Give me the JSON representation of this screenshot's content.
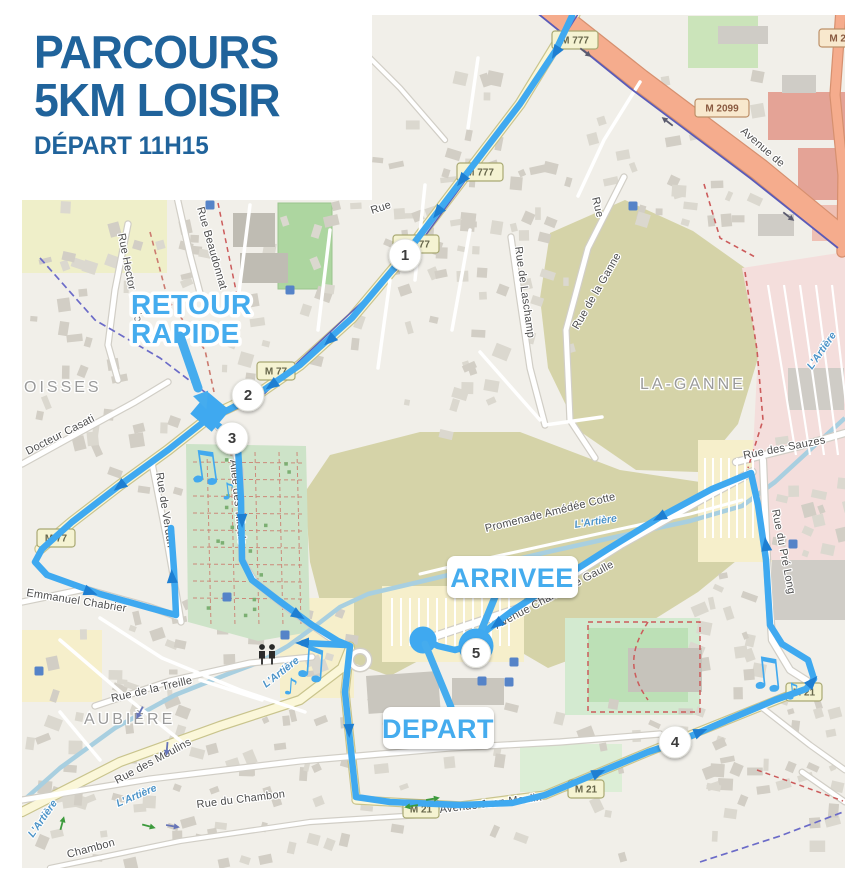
{
  "title": {
    "line1": "PARCOURS",
    "line2": "5KM LOISIR",
    "line3": "DÉPART 11H15"
  },
  "callouts": {
    "retour_line1": "RETOUR",
    "retour_line2": "RAPIDE",
    "arrivee": "ARRIVEE",
    "depart": "DEPART"
  },
  "waypoints": {
    "wp1": "1",
    "wp2": "2",
    "wp3": "3",
    "wp4": "4",
    "wp5": "5"
  },
  "road_badges": {
    "m777_top": "M 777",
    "m777_mid": "M 777",
    "m777_wp1": "M 777",
    "m77_mid": "M 77",
    "m77_left": "M 77",
    "m2099": "M 2099",
    "m2099_corner": "M 2099",
    "m21_a": "M 21",
    "m21_b": "M 21",
    "m21_c": "M 21"
  },
  "streets": {
    "beaudonnat": "Rue Beaudonnat",
    "berlioz": "Rue Hector Berlioz",
    "casati": "Docteur Casati",
    "verdun": "Rue de Verdun",
    "tilleuls": "Allée des Tilleuls",
    "chabrier": "Emmanuel Chabrier",
    "laschamp": "Rue de Laschamp",
    "ganne": "Rue de la Ganne",
    "sauzes": "Rue des Sauzes",
    "prelong": "Rue du Pré Long",
    "promenade": "Promenade Amédée Cotte",
    "gaulle": "Avenue Charles de Gaulle",
    "avenue_de": "Avenue de",
    "treille": "Rue de la Treille",
    "moulins": "Rue des Moulins",
    "chambon_rue": "Rue du Chambon",
    "chambon": "Chambon",
    "jeanmoulin": "Avenue Jean Moulin",
    "rue": "Rue"
  },
  "areas": {
    "oisses": "OISSES",
    "laganne": "LA-GANNE",
    "aubiere": "AUBIÈRE"
  },
  "river": {
    "name": "L'Artière"
  },
  "icons": {
    "music": "♫",
    "music_small": "♪"
  },
  "colors": {
    "title_blue": "#20639B",
    "route_blue": "#3FA9F0",
    "arrow_blue": "#1E7FD2",
    "callout_blue": "#45ACEE",
    "river_blue": "#A8CFE0",
    "road_yellow": "#FBF7D9",
    "trunk_orange": "#F5AC8D",
    "field_olive": "#D5D3A8",
    "cemetery_green": "#CDE3C8",
    "industrial_pink": "#F4DEDC",
    "map_base": "#F1EFE9"
  }
}
